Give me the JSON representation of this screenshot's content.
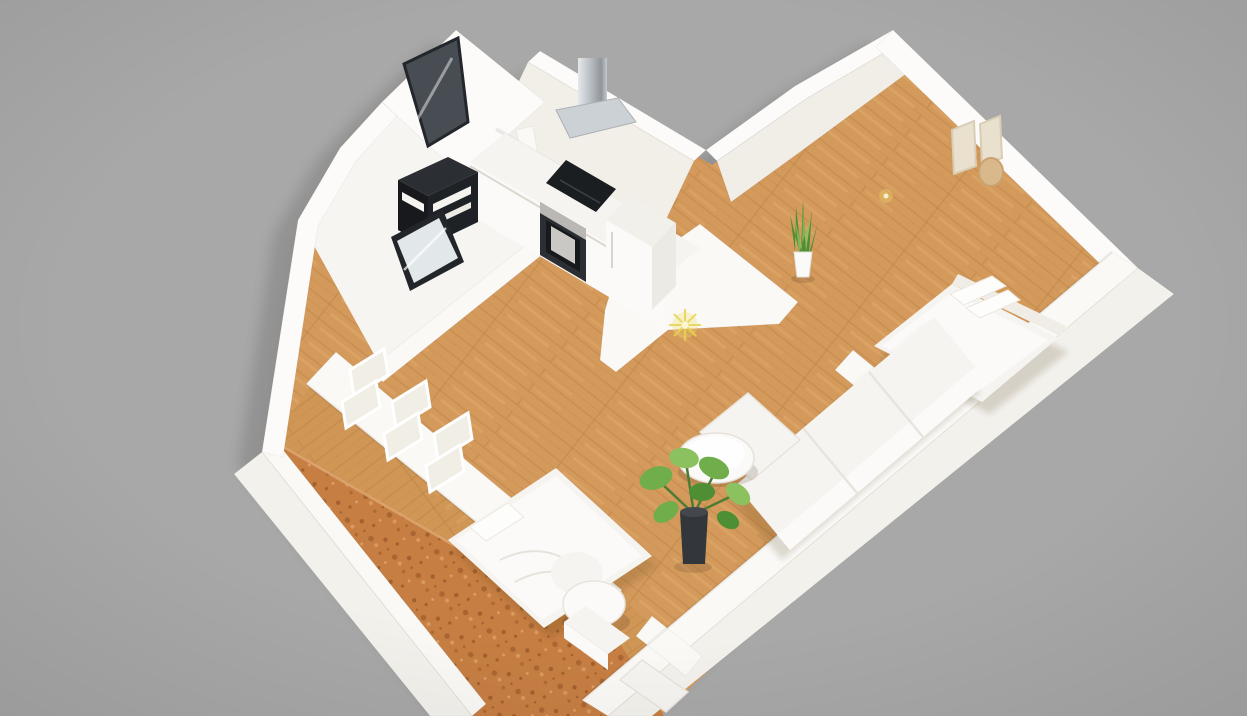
{
  "scene": {
    "type": "3d-apartment-floorplan-render",
    "background": "#a8a8a8",
    "vignette": "rgba(0,0,0,0.07)"
  },
  "colors": {
    "wall_top": "#fcfbf9",
    "wall_white": "#faf9f6",
    "wall_face": "#f2efe9",
    "wall_face_dark": "#ecc",
    "wall_face_soft": "#f1eee8",
    "wall_outer": "#f3f1ec",
    "bath_floor": "#f6f5f2",
    "wood_base": "#d49a5c",
    "wood2_base": "#d09656",
    "wood_dark": "#bb8245",
    "wood_light": "#e4b06f",
    "cork_base": "#c67e42",
    "cork_dark": "#a1602e",
    "cork_light": "#dda067",
    "appliance_dark": "#1b1e21",
    "appliance_mid": "#2b2f33",
    "appliance_deep": "#17191c",
    "steel_light": "#e6e9eb",
    "steel_dark": "#8f959b",
    "glass_door": "#474d53",
    "glass_pane": "#e2e7ea",
    "window_pane": "#f1eee6",
    "plant_green": "#6fae4a",
    "plant_green_dark": "#4e8f36",
    "plant_green_light": "#8cc15f",
    "pot_black": "#33373b",
    "pot_white": "#fafaf8",
    "furniture_white": "#f6f4f0",
    "furniture_highlight": "#fbfaf8",
    "furniture_shade": "#eae6e0",
    "seam": "#e7e3dc",
    "art_beige": "#e9e0cd",
    "art_frame": "#d9cdb6",
    "mirror_wood": "#d9b98c",
    "mirror_wood_edge": "#c9a270",
    "light_yellow": "#f0dd6e",
    "shadow": "rgba(60,45,25,0.16)",
    "building_shadow": "rgba(0,0,0,0.55)",
    "ao": "rgba(0,0,0,0.07)"
  },
  "rooms": [
    {
      "name": "entry-vestibule",
      "items": [
        "glass-entry-door"
      ]
    },
    {
      "name": "kitchen",
      "items": [
        "range-hood",
        "induction-cooktop",
        "built-in-oven",
        "kitchen-counter",
        "refrigerator"
      ]
    },
    {
      "name": "bathroom",
      "items": [
        "dark-shelf-unit",
        "shower-glass-panel"
      ]
    },
    {
      "name": "bedroom-right",
      "items": [
        "double-bed",
        "wall-art-frames",
        "round-mirror",
        "snake-plant",
        "wall-lamp"
      ]
    },
    {
      "name": "living-room",
      "items": [
        "corner-sofa",
        "ottoman",
        "round-coffee-table",
        "monstera-plant",
        "ceiling-light"
      ]
    },
    {
      "name": "bedroom-left",
      "items": [
        "cork-accent-wall",
        "window-panes",
        "platform-bed",
        "lounge-chair",
        "bench",
        "dresser"
      ]
    },
    {
      "name": "hallway",
      "items": [
        "wood-floor"
      ]
    }
  ]
}
